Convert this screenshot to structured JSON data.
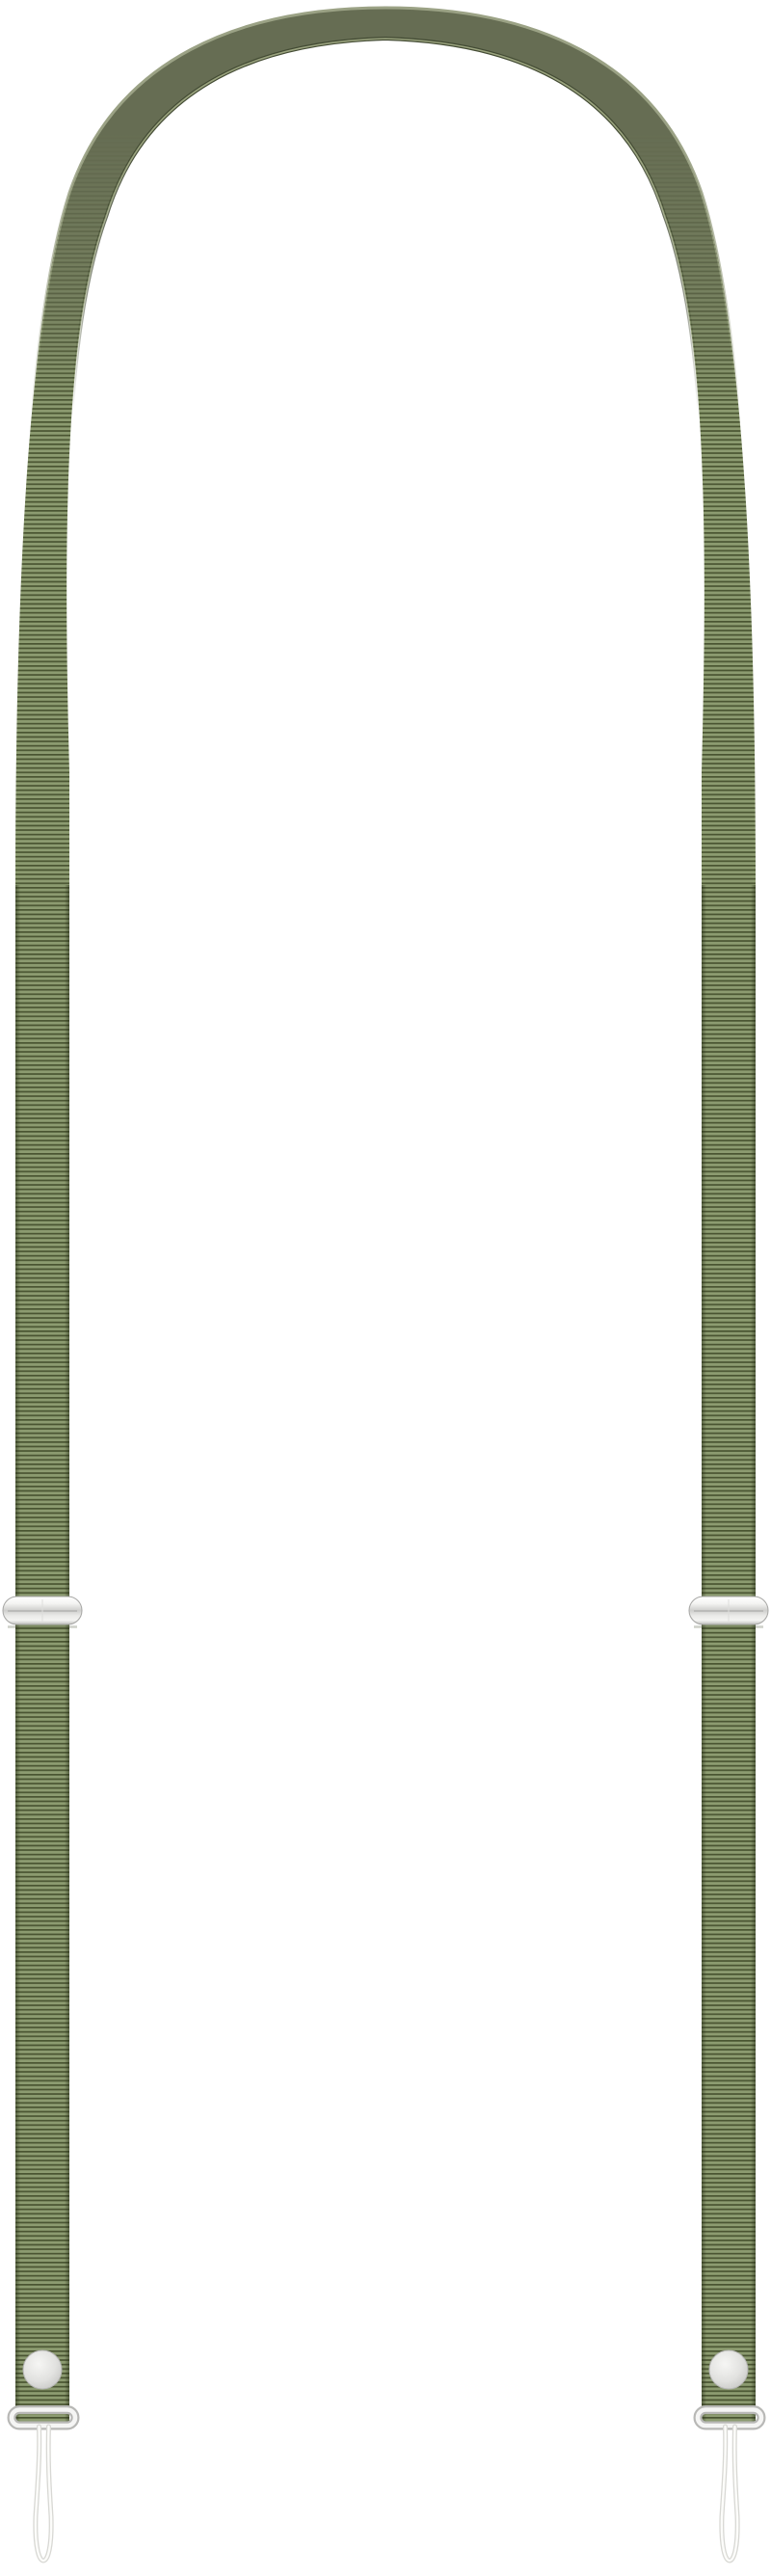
{
  "meta": {
    "type": "product-photo",
    "subject": "Olive green adjustable grosgrain lanyard neck strap with metal slide adjusters, snap studs, end rings and clear cord attachment loops",
    "strap_color_name": "olive green",
    "parts": [
      "strap-arch",
      "strap-left",
      "strap-right",
      "slide-adjuster-left",
      "slide-adjuster-right",
      "snap-button-left",
      "snap-button-right",
      "end-ring-left",
      "end-ring-right",
      "cord-loop-left",
      "cord-loop-right"
    ]
  },
  "colors": {
    "background": "#ffffff",
    "rib_light": "#8c9b70",
    "rib_dark": "#4a5532",
    "strap_edge_shade": "#232a14",
    "arch_body": "#666d53",
    "arch_outer_highlight": "#9ba285",
    "arch_inner_dark": "#434b34",
    "arch_inner_highlight": "#9aa37e",
    "metal_hi": "#ffffff",
    "metal_light": "#f4f4f2",
    "metal_mid": "#cfcfcd",
    "metal_low": "#e9e9e7",
    "metal_dark": "#bfbfbd",
    "metal_outline": "#a5a5a3",
    "metal_seam": "#b4b4b2",
    "metal_seam_vertical": "#dededc",
    "adjuster_shadow": "rgba(60,66,40,0.25)",
    "snap_hi": "#f6f6f4",
    "snap_mid": "#e2e2e0",
    "snap_lo": "#c2c2c0",
    "snap_outline": "#b5b5b3",
    "ring_outline": "#b8b8b6",
    "ring_tube": "#f5f5f4",
    "cord_outline": "#d8d8d4",
    "cord_fill": "#fcfcfa"
  }
}
